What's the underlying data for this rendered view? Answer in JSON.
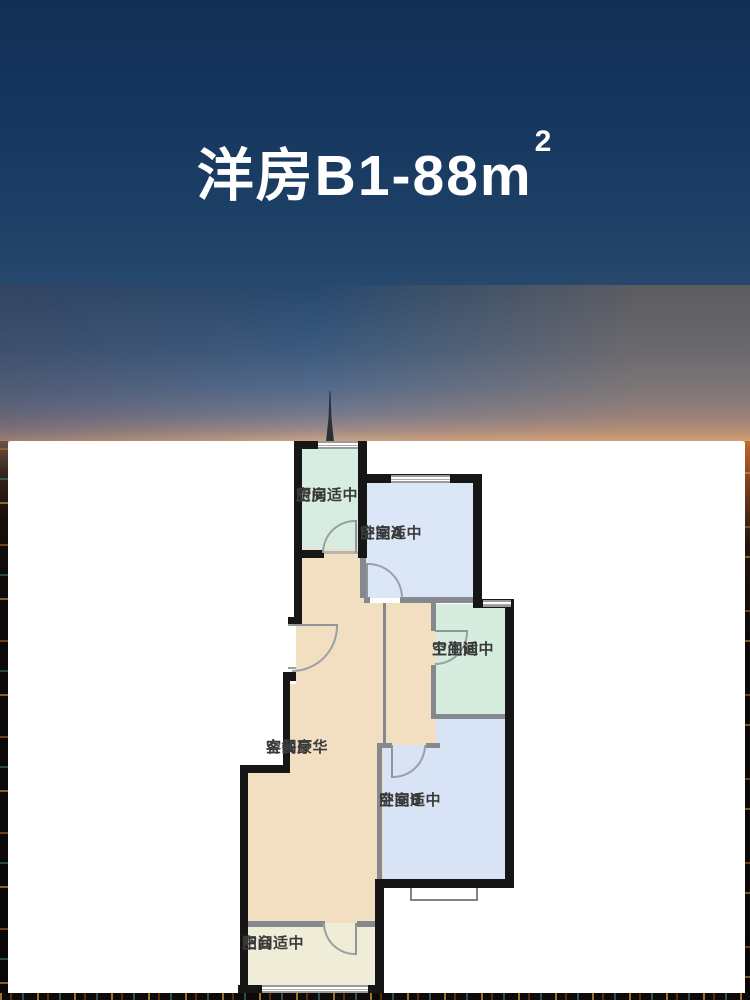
{
  "title": {
    "main": "洋房B1-88m",
    "sup": "2"
  },
  "floorplan": {
    "rooms": {
      "kitchen": {
        "name": "厨房",
        "grade": "空间适中",
        "color": "#d8ede2"
      },
      "bedroomA": {
        "name": "卧室A",
        "grade": "空间适中",
        "color": "#dbe6f7"
      },
      "bathroom": {
        "name": "卫生间",
        "grade": "空间适中",
        "color": "#d6ecdf"
      },
      "living": {
        "name": "客餐厅",
        "grade": "空间豪华",
        "color": "#f2dfc2"
      },
      "bedroomB": {
        "name": "卧室B",
        "grade": "空间适中",
        "color": "#d8e4f6"
      },
      "balcony": {
        "name": "阳台",
        "grade": "空间适中",
        "color": "#efecd8"
      }
    }
  },
  "css_vars": {
    "wall": "#161616",
    "thin-wall": "#85898d",
    "frame": "#9aa0a4",
    "label": "#3a3a3a",
    "panel": "#ffffff",
    "sky-top": "#122e55",
    "sky-mid": "#3b5a7f",
    "sunset": "#d9a87a",
    "night": "#0b0807"
  }
}
